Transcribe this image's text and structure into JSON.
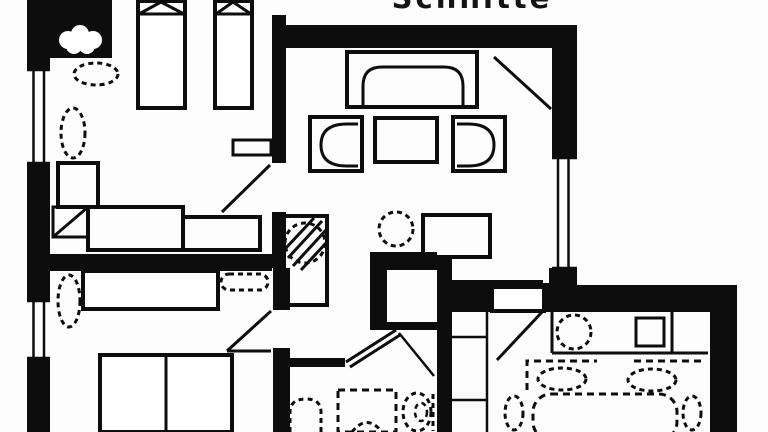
{
  "title": {
    "text": "Schnitte"
  },
  "colors": {
    "ink": "#0d0d0d",
    "paper": "#ffffff"
  },
  "floor_plan": {
    "type": "apartment-floor-plan",
    "style": "black-and-white architectural drawing, cropped at top and bottom edges",
    "rooms": [
      {
        "name": "bedroom-top-left",
        "furniture": [
          "single-bed",
          "single-bed",
          "potted-plant",
          "potted-plant",
          "nightstand",
          "chair",
          "desk",
          "sideboard",
          "wall-shelf"
        ]
      },
      {
        "name": "bedroom-bottom-left",
        "furniture": [
          "single-bed-with-bolster-pillow",
          "potted-plant",
          "double-bed"
        ]
      },
      {
        "name": "living-room",
        "furniture": [
          "sofa",
          "armchair",
          "coffee-table",
          "armchair",
          "tiled-stove",
          "potted-plant",
          "tv-cabinet"
        ]
      },
      {
        "name": "hallway",
        "furniture": [
          "built-in-closet",
          "shelf-niche"
        ]
      },
      {
        "name": "bathroom",
        "furniture": [
          "washbasin",
          "shower",
          "toilet"
        ]
      },
      {
        "name": "kitchen-dining",
        "furniture": [
          "kitchen-counter",
          "sink",
          "cooktop",
          "dining-table",
          "dining-chair",
          "dining-chair",
          "dining-chair",
          "dining-chair",
          "rug"
        ]
      }
    ],
    "openings": [
      "window-left-upper",
      "window-left-lower",
      "window-right",
      "bedroom-door",
      "bedroom-door",
      "bathroom-door",
      "kitchen-door",
      "entrance-door"
    ]
  }
}
